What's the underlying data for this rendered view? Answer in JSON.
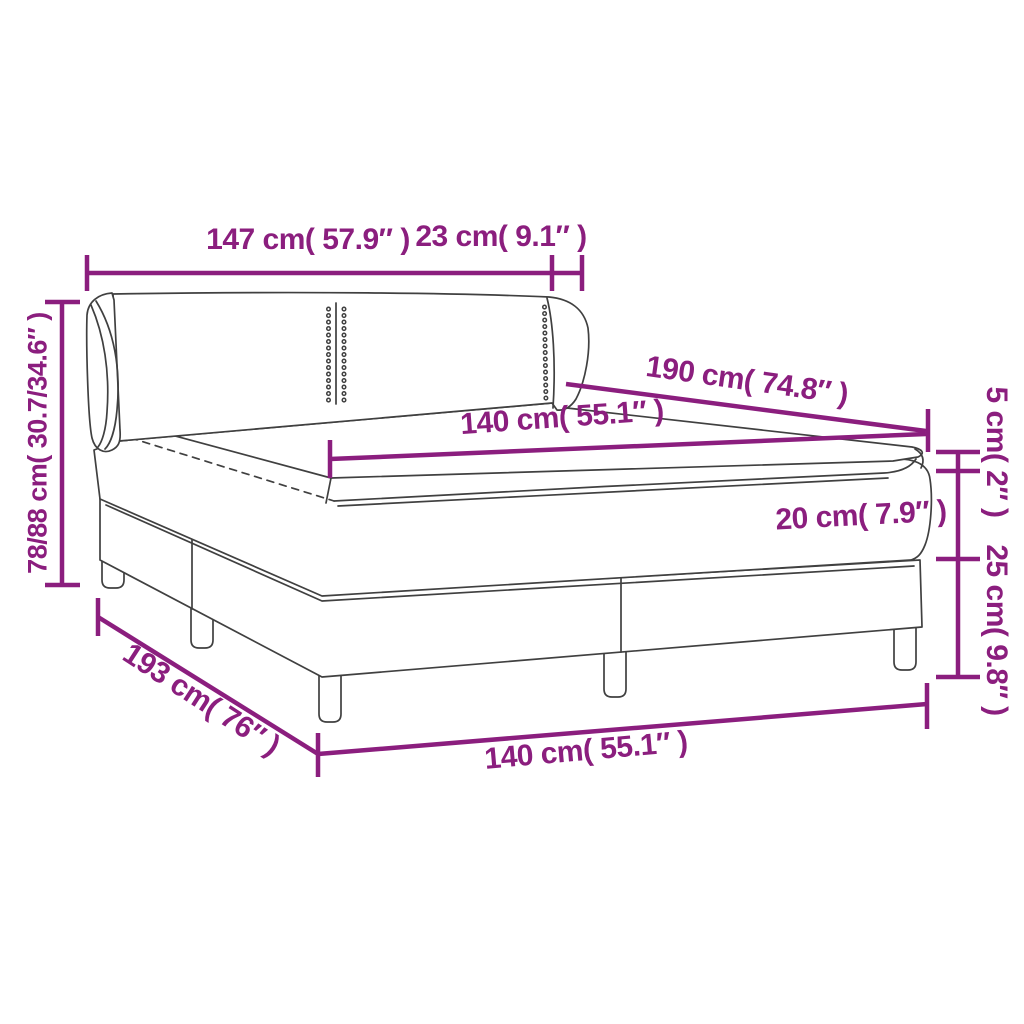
{
  "diagram": {
    "kind": "product-dimension-diagram",
    "subject": "box spring bed with winged headboard, mattress and topper",
    "background_color": "#ffffff",
    "accent_color": "#8b1e7e",
    "line_art_color": "#404040",
    "labels": {
      "headboard_width": "147 cm( 57.9″ )",
      "wing_depth": "23 cm( 9.1″ )",
      "total_height": "78/88 cm( 30.7/34.6″ )",
      "bed_length": "190 cm( 74.8″ )",
      "mattress_width_top": "140 cm( 55.1″ )",
      "topper_height": "5 cm( 2″ )",
      "mattress_height": "20 cm( 7.9″ )",
      "base_height": "25 cm( 9.8″ )",
      "base_length": "193 cm( 76″ )",
      "base_width_bottom": "140 cm( 55.1″ )"
    }
  }
}
